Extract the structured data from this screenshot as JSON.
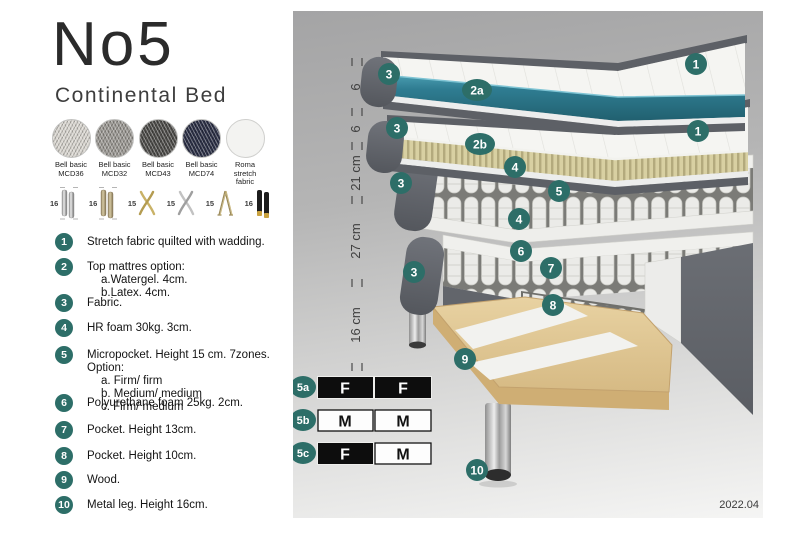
{
  "header": {
    "title": "No5",
    "subtitle": "Continental Bed"
  },
  "swatches": [
    {
      "name": "Bell basic MCD36"
    },
    {
      "name": "Bell basic MCD32"
    },
    {
      "name": "Bell basic MCD43"
    },
    {
      "name": "Bell basic MCD74"
    },
    {
      "name": "Roma stretch fabric"
    }
  ],
  "legs": [
    {
      "height": "16",
      "type": "cylinder-silver"
    },
    {
      "height": "16",
      "type": "cylinder-brass"
    },
    {
      "height": "15",
      "type": "cross-gold"
    },
    {
      "height": "15",
      "type": "cross-silver"
    },
    {
      "height": "15",
      "type": "hairpin"
    },
    {
      "height": "16",
      "type": "cylinder-black-gold"
    }
  ],
  "list": {
    "i1": {
      "num": "1",
      "text": "Stretch fabric quilted with wadding."
    },
    "i2": {
      "num": "2",
      "text": "Top mattres option:",
      "subs": {
        "a": "a.Watergel. 4cm.",
        "b": "b.Latex. 4cm."
      }
    },
    "i3": {
      "num": "3",
      "text": "Fabric."
    },
    "i4": {
      "num": "4",
      "text": "HR foam 30kg. 3cm."
    },
    "i5": {
      "num": "5",
      "text": "Micropocket. Height 15 cm. 7zones. Option:",
      "subs": {
        "a": "a. Firm/ firm",
        "b": "b. Medium/ medium",
        "c": "c. Firm/ medium"
      }
    },
    "i6": {
      "num": "6",
      "text": "Polyurethane foam 25kg. 2cm."
    },
    "i7": {
      "num": "7",
      "text": "Pocket. Height 13cm."
    },
    "i8": {
      "num": "8",
      "text": "Pocket. Height 10cm."
    },
    "i9": {
      "num": "9",
      "text": "Wood."
    },
    "i10": {
      "num": "10",
      "text": "Metal leg. Height 16cm."
    }
  },
  "diagram": {
    "ruler": {
      "r1": "6",
      "r2": "6",
      "r3": "21 cm",
      "r4": "27 cm",
      "r5": "16 cm"
    },
    "callouts": {
      "c1": "1",
      "c2a": "2a",
      "c2b": "2b",
      "c3": "3",
      "c4": "4",
      "c5": "5",
      "c6": "6",
      "c7": "7",
      "c8": "8",
      "c9": "9",
      "c10": "10"
    },
    "firmness_table": {
      "row1": {
        "label": "5a",
        "cell1": {
          "text": "F",
          "style": "dark"
        },
        "cell2": {
          "text": "F",
          "style": "dark"
        }
      },
      "row2": {
        "label": "5b",
        "cell1": {
          "text": "M",
          "style": "light"
        },
        "cell2": {
          "text": "M",
          "style": "light"
        }
      },
      "row3": {
        "label": "5c",
        "cell1": {
          "text": "F",
          "style": "dark"
        },
        "cell2": {
          "text": "M",
          "style": "light"
        }
      }
    },
    "version": "2022.04"
  },
  "colors": {
    "accent_teal": "#2d6e68",
    "watergel_teal": "#2f7d92",
    "latex_beige": "#d8d0a2",
    "fabric_gray": "#5d6066",
    "wood": "#dcc18e",
    "table_dark": "#0d0d0d"
  }
}
